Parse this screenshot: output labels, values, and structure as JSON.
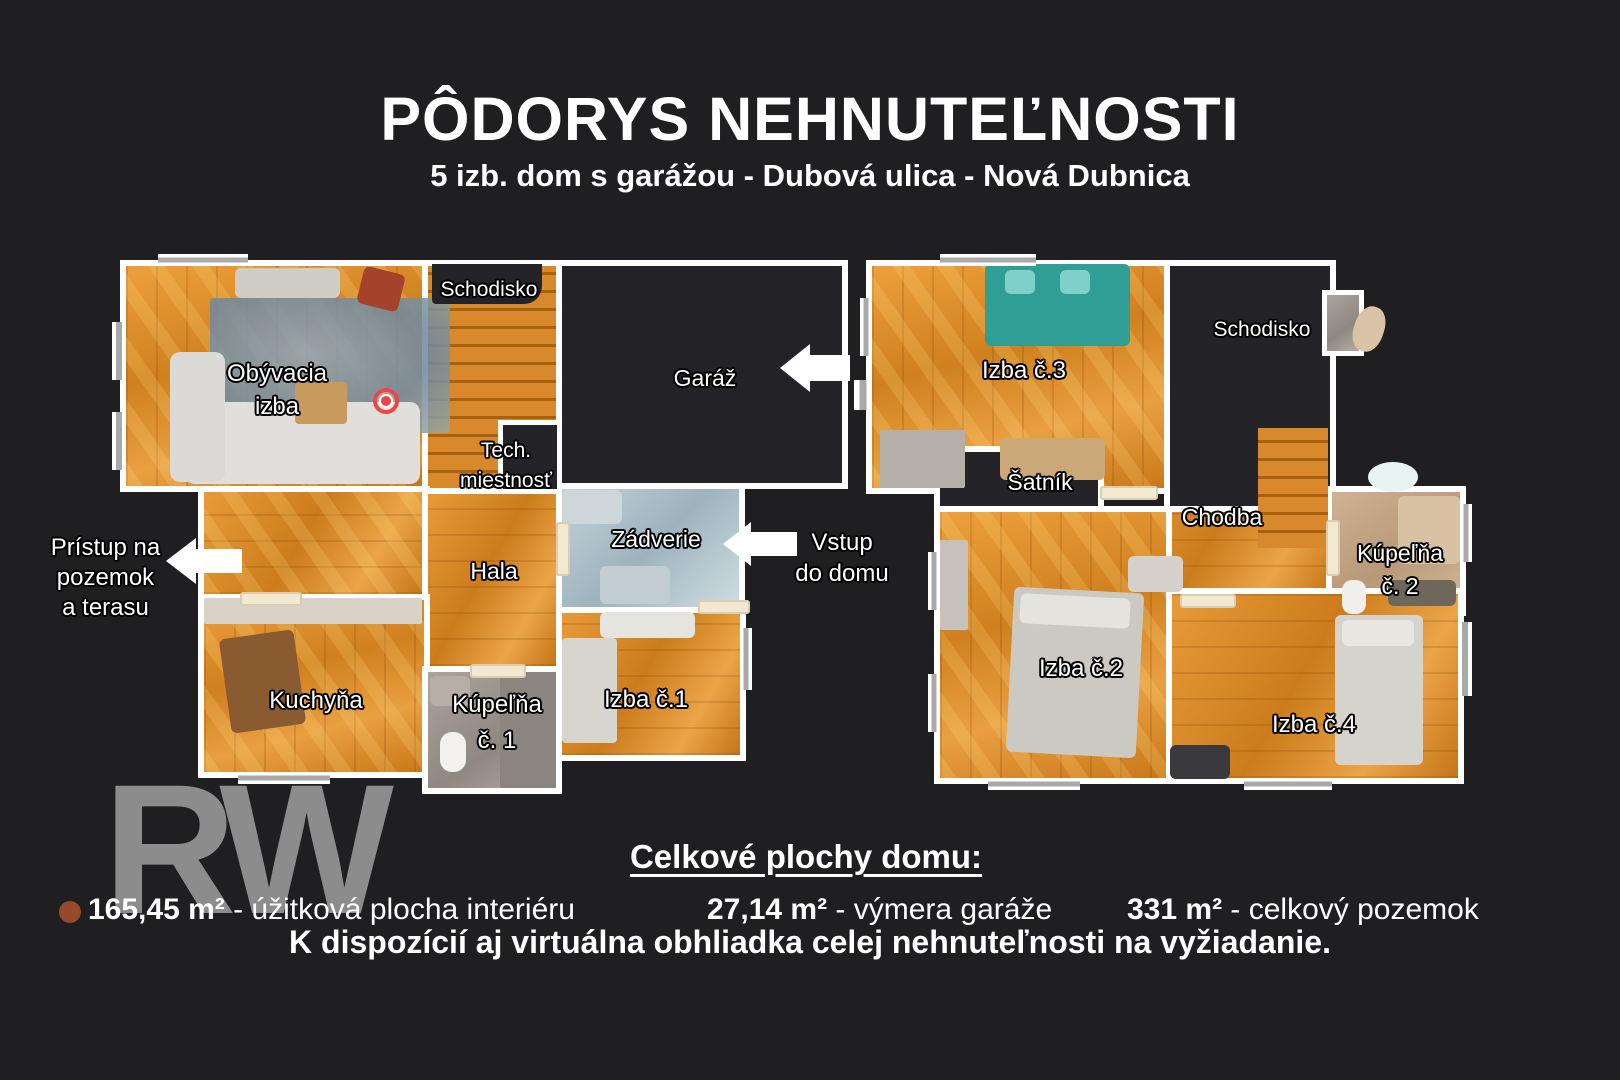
{
  "header": {
    "title": "PÔDORYS NEHNUTEĽNOSTI",
    "subtitle": "5 izb. dom s garážou - Dubová ulica - Nová Dubnica"
  },
  "floor1": {
    "rooms": {
      "obyvacia": {
        "line1": "Obývacia",
        "line2": "izba"
      },
      "schodisko": "Schodisko",
      "tech": {
        "line1": "Tech.",
        "line2": "miestnosť"
      },
      "garaz": "Garáž",
      "hala": "Hala",
      "zadverie": "Zádverie",
      "kuchyna": "Kuchyňa",
      "kupelna1": {
        "line1": "Kúpeľňa",
        "line2": "č. 1"
      },
      "izba1": "Izba č.1"
    },
    "annotations": {
      "pristup": {
        "line1": "Prístup na",
        "line2": "pozemok",
        "line3": "a terasu"
      },
      "vstup": {
        "line1": "Vstup",
        "line2": "do domu"
      }
    }
  },
  "floor2": {
    "rooms": {
      "izba3": "Izba č.3",
      "schodisko": "Schodisko",
      "satnik": "Šatník",
      "chodba": "Chodba",
      "kupelna2": {
        "line1": "Kúpeľňa",
        "line2": "č. 2"
      },
      "izba2": "Izba č.2",
      "izba4": "Izba č.4"
    }
  },
  "footer": {
    "heading": "Celkové plochy domu:",
    "areas": [
      {
        "value": "165,45 m²",
        "label": " - úžitková plocha interiéru"
      },
      {
        "value": "27,14 m²",
        "label": " - výmera garáže"
      },
      {
        "value": "331 m²",
        "label": " - celkový pozemok"
      }
    ],
    "note": "K dispozícií aj virtuálna obhliadka celej nehnuteľnosti na vyžiadanie.",
    "watermark": "RW"
  },
  "colors": {
    "background": "#1f1f22",
    "wall": "#ffffff",
    "wood": "#d8882a",
    "dark_room": "#232328",
    "marker_red": "#ee4545",
    "teal_sofa": "#2f9f96",
    "brand_dot": "#96492b",
    "watermark_gray": "#8c8c8c"
  }
}
